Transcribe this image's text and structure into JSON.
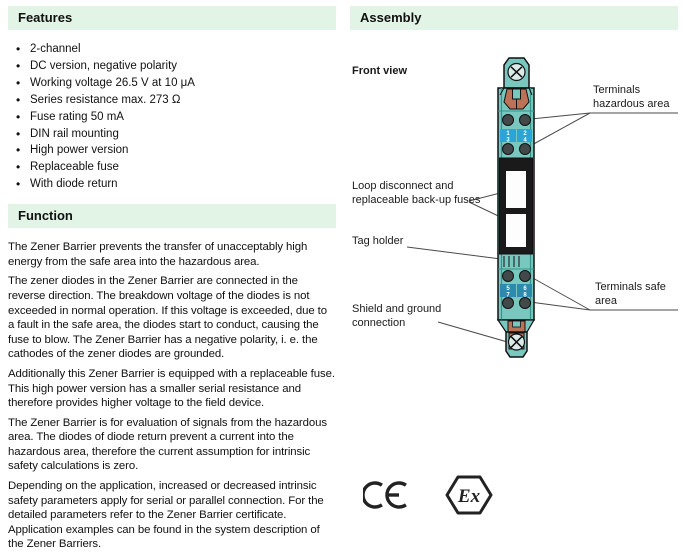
{
  "features": {
    "title": "Features",
    "items": [
      "2-channel",
      "DC version, negative polarity",
      "Working voltage 26.5 V at 10 μA",
      "Series resistance max. 273 Ω",
      "Fuse rating 50 mA",
      "DIN rail mounting",
      "High power version",
      "Replaceable fuse",
      "With diode return"
    ]
  },
  "function": {
    "title": "Function",
    "paragraphs": [
      "The Zener Barrier prevents the transfer of unacceptably high energy from the safe area into the hazardous area.",
      "The zener diodes in the Zener Barrier are connected in the reverse direction. The breakdown voltage of the diodes is not exceeded in normal operation. If this voltage is exceeded, due to a fault in the safe area, the diodes start to conduct, causing the fuse to blow. The Zener Barrier has a negative polarity, i. e. the cathodes of the zener diodes are grounded.",
      "Additionally this Zener Barrier is equipped with a replaceable fuse. This high power version has a smaller serial resistance and therefore provides higher voltage to the field device.",
      "The Zener Barrier is for evaluation of signals from the hazardous area. The diodes of diode return prevent a current into the hazardous area, therefore the current assumption for intrinsic safety calculations is zero.",
      "Depending on the application, increased or decreased intrinsic safety parameters apply for serial or parallel connection. For the detailed parameters refer to the Zener Barrier certificate. Application examples can be found in the system description of the Zener Barriers."
    ]
  },
  "assembly": {
    "title": "Assembly",
    "view_label": "Front view",
    "callouts": {
      "terminals_hazardous": "Terminals hazardous area",
      "loop_disconnect": "Loop disconnect and replaceable back-up fuses",
      "tag_holder": "Tag holder",
      "terminals_safe": "Terminals safe area",
      "shield_ground": "Shield and ground connection"
    },
    "device": {
      "terminal_labels": [
        "1",
        "2",
        "3",
        "4",
        "5",
        "6",
        "7",
        "8"
      ]
    },
    "certifications": {
      "ce": "CE",
      "ex": "Ex"
    }
  },
  "colors": {
    "header_bg": "#e2f4e5",
    "device_teal": "#79c8bf",
    "device_teal_edge": "#35948b",
    "device_copper": "#bb7257",
    "terminal_gray": "#43484b",
    "band_blue_hazardous": "#2ba4d8",
    "band_blue_safe": "#2d89ae"
  }
}
